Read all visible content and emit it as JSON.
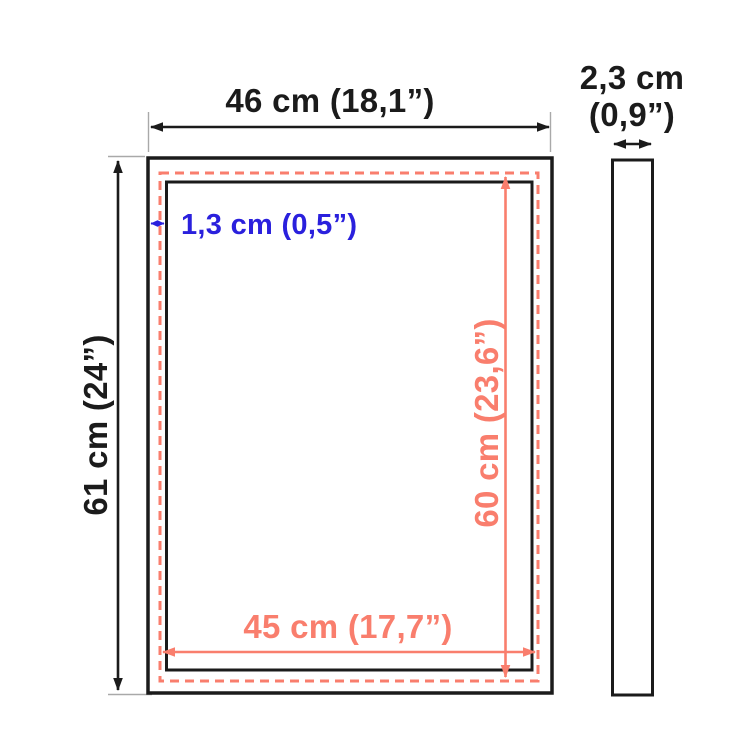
{
  "diagram": {
    "type": "frame-dimensions-diagram",
    "colors": {
      "ink_black": "#1b1b1b",
      "dimension_coral": "#f97e6d",
      "dimension_blue": "#2a20dd",
      "extension_gray": "#a9a9a9",
      "background": "#ffffff"
    },
    "labels": {
      "outer_width": "46 cm (18,1”)",
      "outer_height": "61 cm (24”)",
      "inner_width": "45 cm (17,7”)",
      "inner_height": "60 cm (23,6”)",
      "frame_face": "1,3 cm (0,5”)",
      "depth_cm": "2,3 cm",
      "depth_in": "(0,9”)"
    },
    "dimensions": [
      {
        "name": "outer-width",
        "cm": "46",
        "inches": "18,1",
        "color": "black"
      },
      {
        "name": "outer-height",
        "cm": "61",
        "inches": "24",
        "color": "black"
      },
      {
        "name": "inner-width",
        "cm": "45",
        "inches": "17,7",
        "color": "coral"
      },
      {
        "name": "inner-height",
        "cm": "60",
        "inches": "23,6",
        "color": "coral"
      },
      {
        "name": "frame-face-width",
        "cm": "1,3",
        "inches": "0,5",
        "color": "blue"
      },
      {
        "name": "depth",
        "cm": "2,3",
        "inches": "0,9",
        "color": "black"
      }
    ]
  }
}
